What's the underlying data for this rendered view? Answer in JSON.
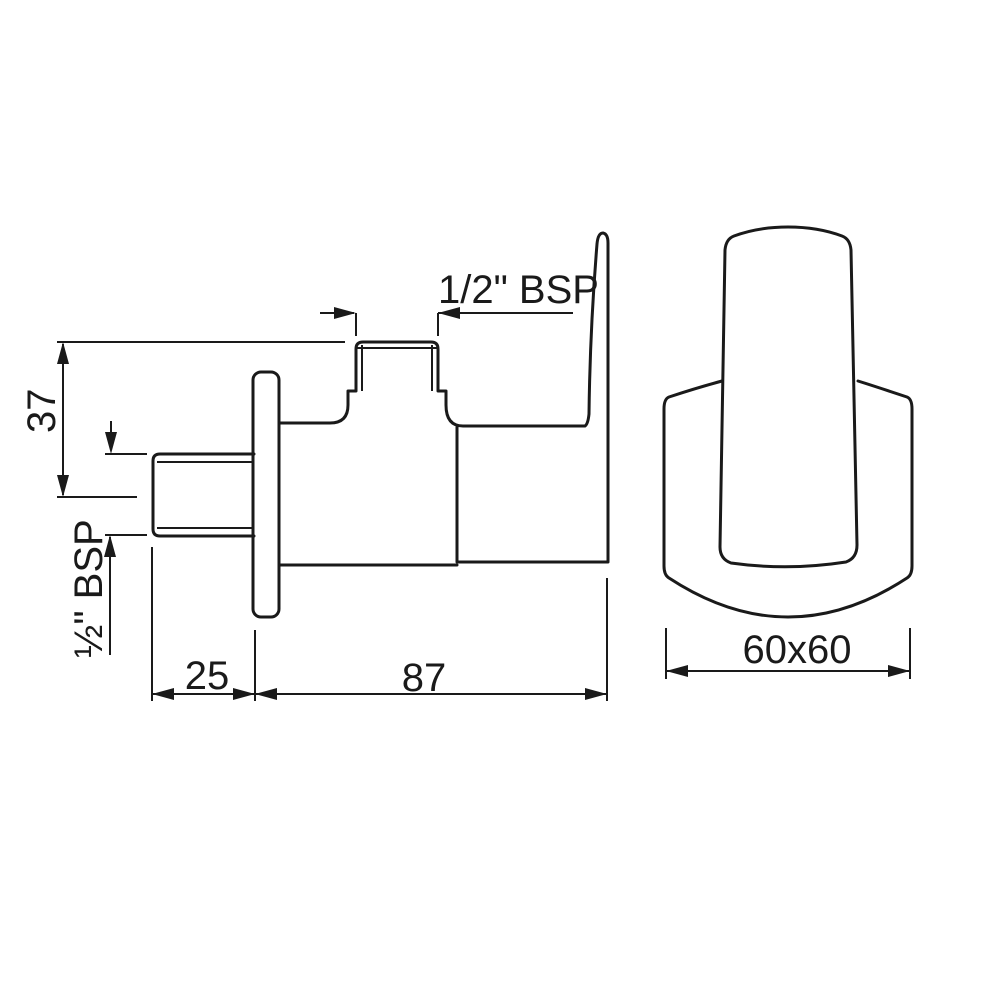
{
  "labels": {
    "height": "37",
    "outlet_thread": "1/2\" BSP",
    "inlet_thread": "½\" BSP",
    "inlet_length": "25",
    "body_length": "87",
    "faceplate_size": "60x60"
  },
  "colors": {
    "line": "#1a1a1a",
    "background": "#ffffff"
  }
}
